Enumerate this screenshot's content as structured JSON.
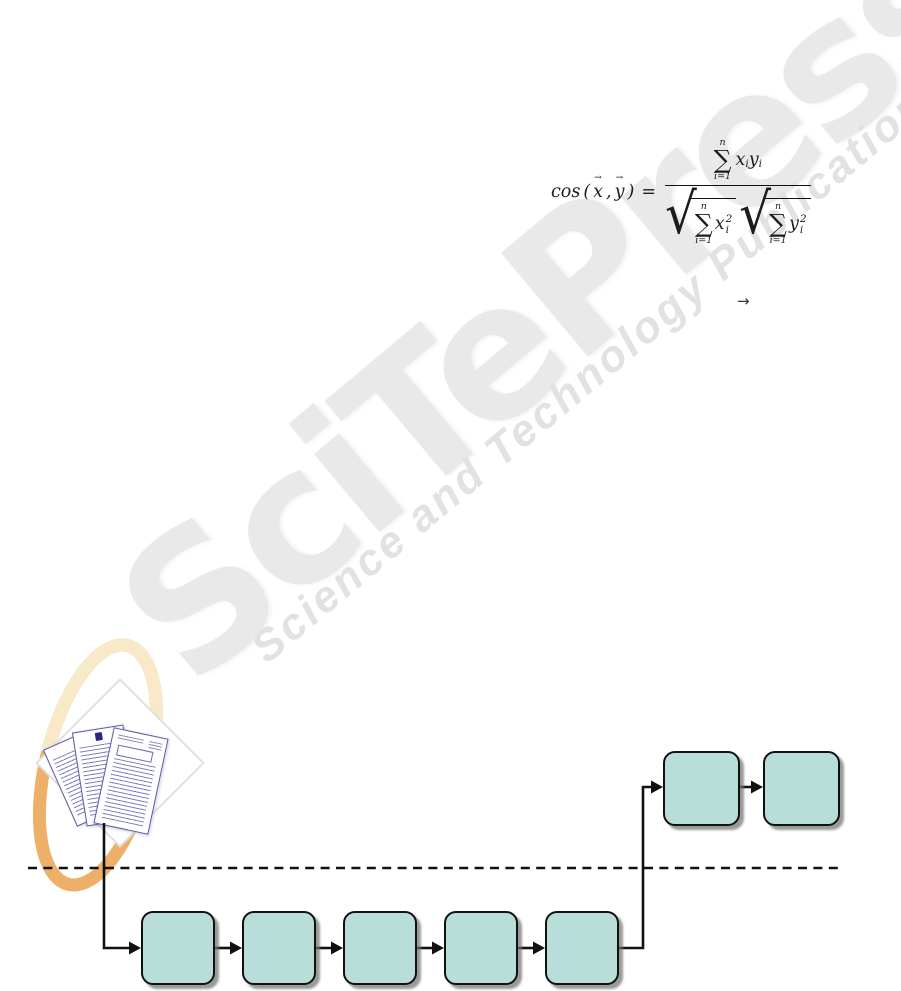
{
  "page": {
    "width": 901,
    "height": 991,
    "background": "#ffffff"
  },
  "watermark": {
    "logo_text": "SciTePress",
    "tagline_text": "Science and Technology Publications",
    "logo_color": "#e9e9e9",
    "tagline_color": "#e2e2e2"
  },
  "equation": {
    "function": "cos",
    "open_paren": "(",
    "comma": ",",
    "close_paren": ")",
    "equals": "=",
    "vector_arrow": "→",
    "vec_x": "x",
    "vec_y": "y",
    "sum_symbol": "∑",
    "sum_upper": "n",
    "sum_lower": "i=1",
    "num_x": "x",
    "num_x_sub": "i",
    "num_y": "y",
    "num_y_sub": "i",
    "den1_base": "x",
    "den1_sub": "i",
    "den1_sup": "2",
    "den2_base": "y",
    "den2_sub": "i",
    "den2_sup": "2",
    "radical_sign": "√"
  },
  "inline_arrow": "→",
  "flowchart": {
    "box_fill": "#b9deda",
    "box_border": "#111111",
    "connector_color": "#111111",
    "bottom_row": {
      "count": 5,
      "labels": [
        "",
        "",
        "",
        "",
        ""
      ]
    },
    "top_row": {
      "count": 2,
      "labels": [
        "",
        ""
      ]
    },
    "divider_style": "dashed"
  },
  "documents_icon": {
    "page_count": 3,
    "border_color": "#5a5aa5",
    "text_color": "#5656a8"
  },
  "logo_mark": {
    "ring_color_light": "#f8e9c9",
    "ring_color_dark": "#eeb069",
    "diamond_border": "#e0e0e0",
    "diamond_fill": "#ffffff"
  }
}
